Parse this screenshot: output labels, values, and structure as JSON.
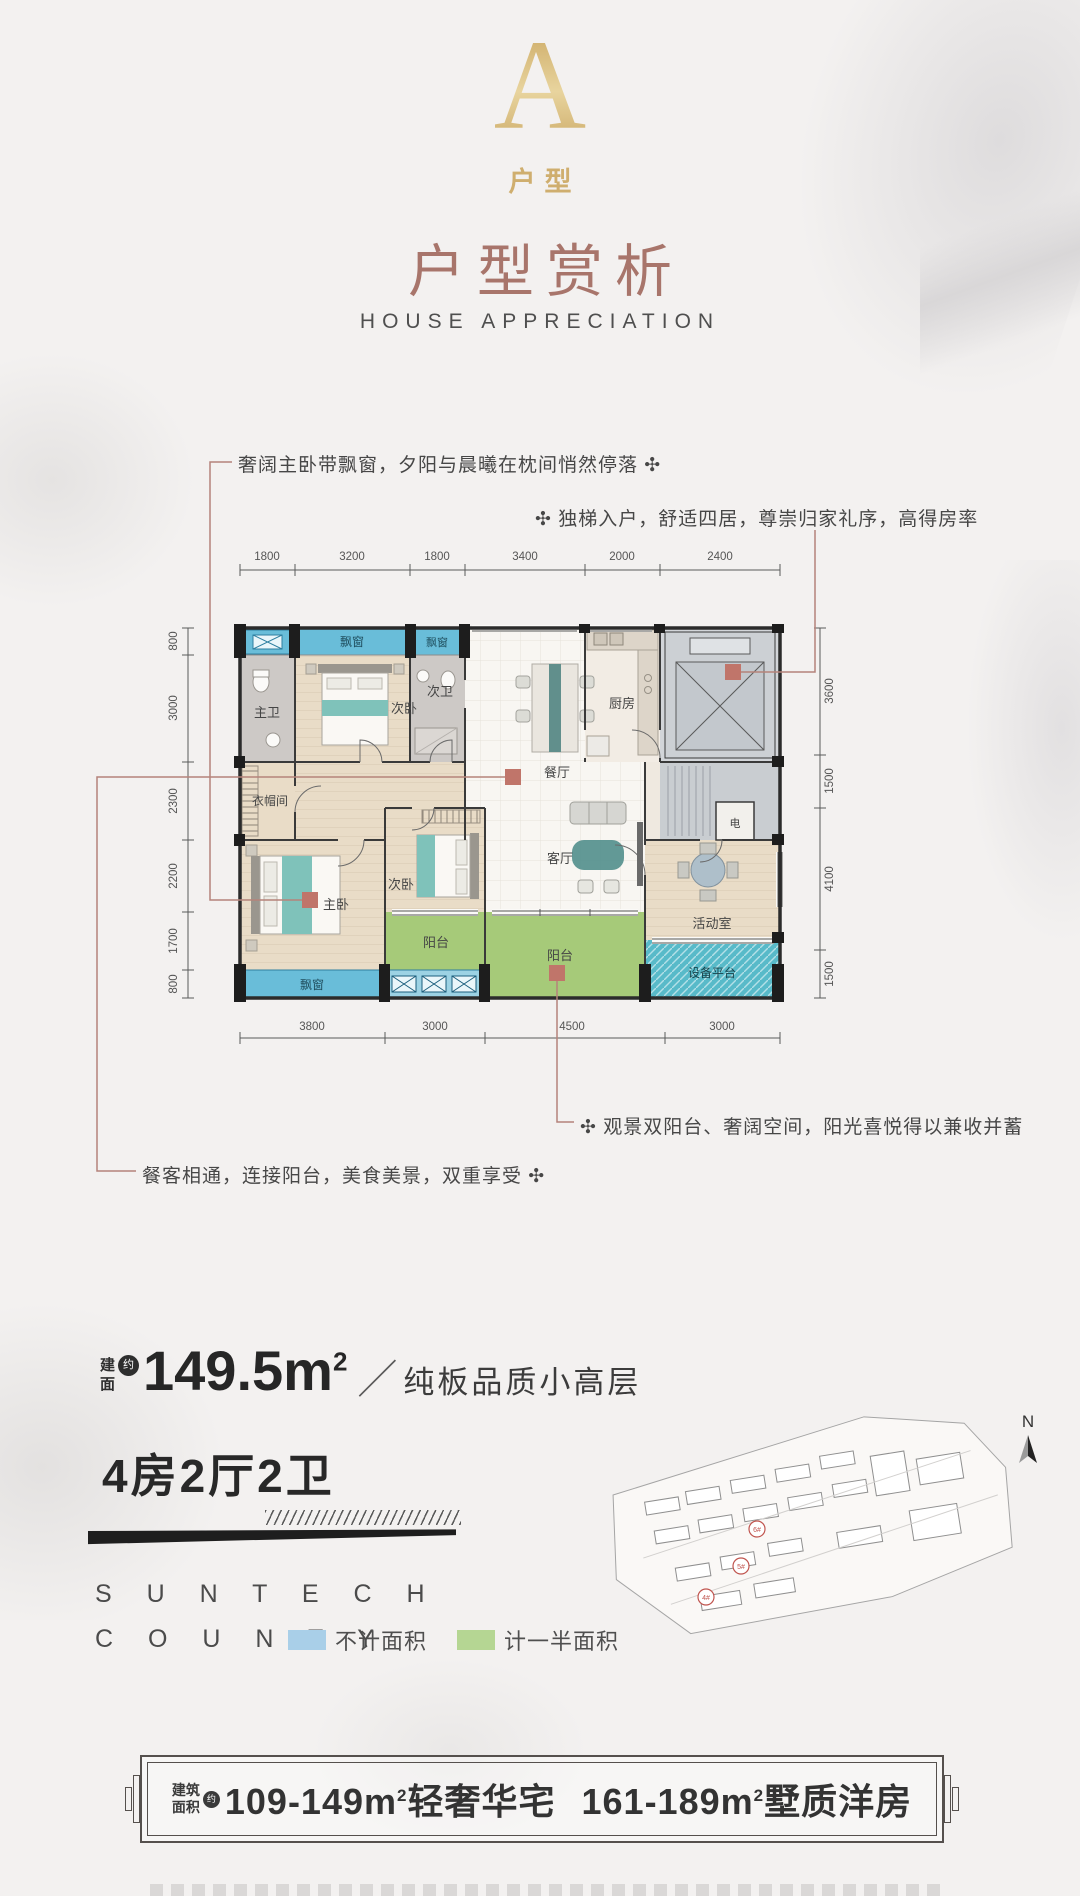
{
  "unit_badge": {
    "letter": "A",
    "label": "户型"
  },
  "header": {
    "title": "户型赏析",
    "subtitle": "HOUSE APPRECIATION"
  },
  "callouts": {
    "master_bedroom": "奢阔主卧带飘窗，夕阳与晨曦在枕间悄然停落 ✣",
    "private_elevator": "✣ 独梯入户，舒适四居，尊崇归家礼序，高得房率",
    "double_balcony": "✣ 观景双阳台、奢阔空间，阳光喜悦得以兼收并蓄",
    "dining_living": "餐客相通，连接阳台，美食美景，双重享受 ✣"
  },
  "floorplan": {
    "dims_top": [
      "1800",
      "3200",
      "1800",
      "3400",
      "2000",
      "2400"
    ],
    "dims_left": [
      "800",
      "3000",
      "2300",
      "2200",
      "1700",
      "800"
    ],
    "dims_right": [
      "3600",
      "1500",
      "4100",
      "1500"
    ],
    "dims_bottom": [
      "3800",
      "3000",
      "4500",
      "3000"
    ],
    "rooms": {
      "master_bath": "主卫",
      "bedroom2": "次卧",
      "bath2": "次卫",
      "dining": "餐厅",
      "kitchen": "厨房",
      "cloakroom": "衣帽间",
      "master_bedroom": "主卧",
      "bedroom3": "次卧",
      "living": "客厅",
      "balcony1": "阳台",
      "balcony2": "阳台",
      "activity": "活动室",
      "equipment": "设备平台",
      "electric": "电",
      "bay_window_top1": "飘窗",
      "bay_window_top2": "飘窗",
      "bay_window_bottom": "飘窗"
    }
  },
  "area": {
    "label_line1": "建",
    "label_line2": "面",
    "approx_badge": "约",
    "value": "149.5m",
    "sup": "2",
    "slash": "／",
    "descriptor": "纯板品质小高层"
  },
  "layout_label": "4房2厅2卫",
  "brand": {
    "name_line1": "S U N T E C H",
    "name_line2": "C O U N T Y"
  },
  "legend": {
    "items": [
      {
        "label": "不计面积",
        "color": "#a9cfe8"
      },
      {
        "label": "计一半面积",
        "color": "#b5d693"
      }
    ]
  },
  "siteplan": {
    "compass_label": "N",
    "badges": [
      "6#",
      "5#",
      "4#"
    ]
  },
  "banner": {
    "label_line1": "建筑",
    "label_line2": "面积",
    "approx_badge": "约",
    "range1": "109-149m",
    "sup1": "2",
    "desc1": "轻奢华宅",
    "range2": "161-189m",
    "sup2": "2",
    "desc2": "墅质洋房"
  },
  "colors": {
    "title_brown": "#a8756b",
    "gold": "#d4b474",
    "accent_red": "#c0756a",
    "leader_line": "#b5837a",
    "plan_window_blue": "#69bdd9",
    "plan_balcony_green": "#a6ca79",
    "plan_equipment_teal": "#58bac9",
    "legend_blue": "#a9cfe8",
    "legend_green": "#b5d693"
  }
}
